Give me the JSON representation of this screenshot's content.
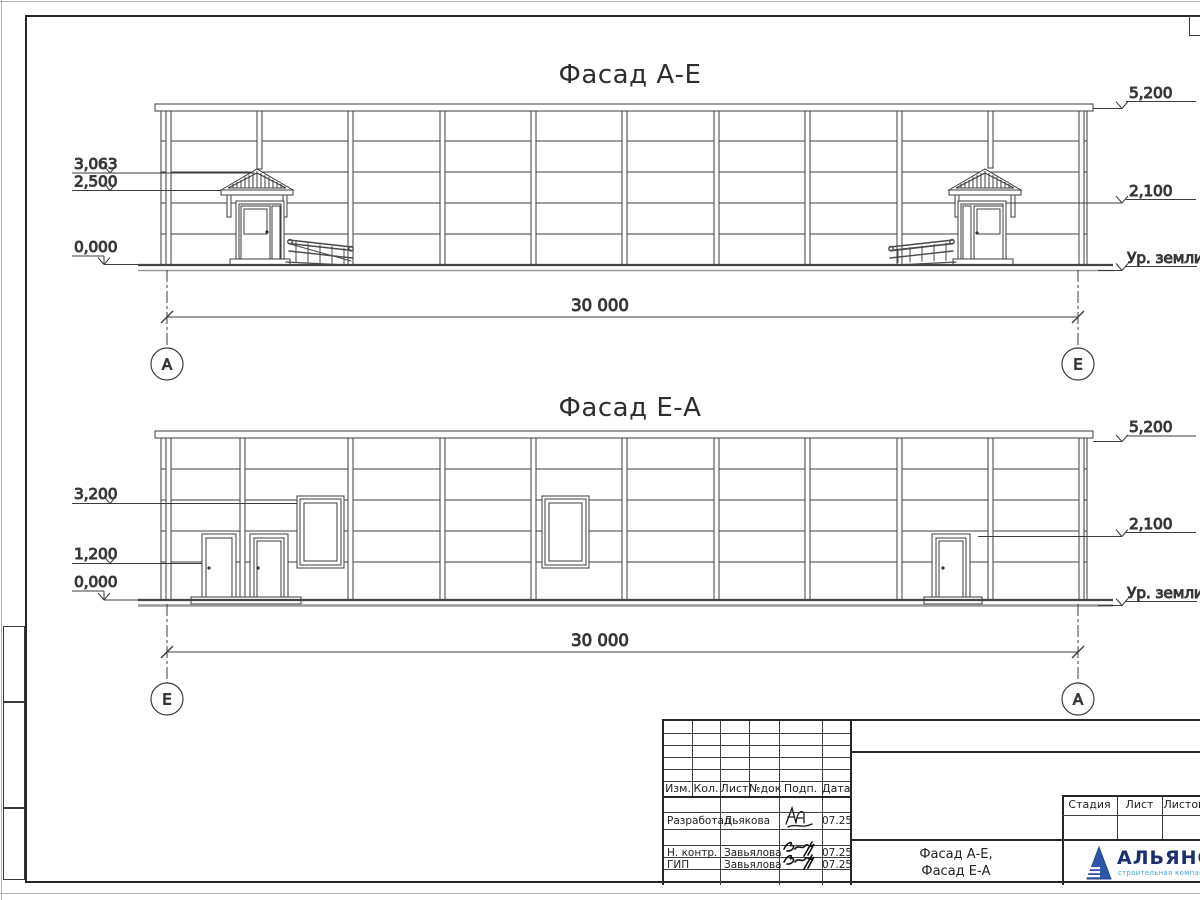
{
  "drawing": {
    "facade1": {
      "title": "Фасад А-Е",
      "marks_left": {
        "m1": "3,063",
        "m2": "2,500",
        "m3": "0,000"
      },
      "marks_right": {
        "top": "5,200",
        "mid": "2,100",
        "ground": "Ур. земли"
      },
      "span_dim": "30 000",
      "axis_left": "А",
      "axis_right": "Е"
    },
    "facade2": {
      "title": "Фасад Е-А",
      "marks_left": {
        "m1": "3,200",
        "m2": "1,200",
        "m3": "0,000"
      },
      "marks_right": {
        "top": "5,200",
        "mid": "2,100",
        "ground": "Ур. земли"
      },
      "span_dim": "30 000",
      "axis_left": "Е",
      "axis_right": "А"
    }
  },
  "title_block": {
    "revision_header": {
      "izm": "Изм.",
      "kol": "Кол.",
      "list": "Лист",
      "ndok": "№док",
      "podp": "Подп.",
      "data": "Дата"
    },
    "staff": [
      {
        "role": "Разработал",
        "name": "Дьякова",
        "date": "07.25"
      },
      {
        "role": "Н. контр.",
        "name": "Завьялова",
        "date": "07.25"
      },
      {
        "role": "ГИП",
        "name": "Завьялова",
        "date": "07.25"
      }
    ],
    "sheet_title_line1": "Фасад А-Е,",
    "sheet_title_line2": "Фасад Е-А",
    "stage": {
      "stadia": "Стадия",
      "list": "Лист",
      "listov": "Листов"
    },
    "logo": {
      "name": "АЛЬЯНС",
      "subtitle": "строительная компания"
    }
  },
  "colors": {
    "line": "#3c3c3c",
    "logo_navy": "#1d2f6f",
    "logo_blue": "#2d55a8",
    "logo_light": "#45a0d6"
  }
}
